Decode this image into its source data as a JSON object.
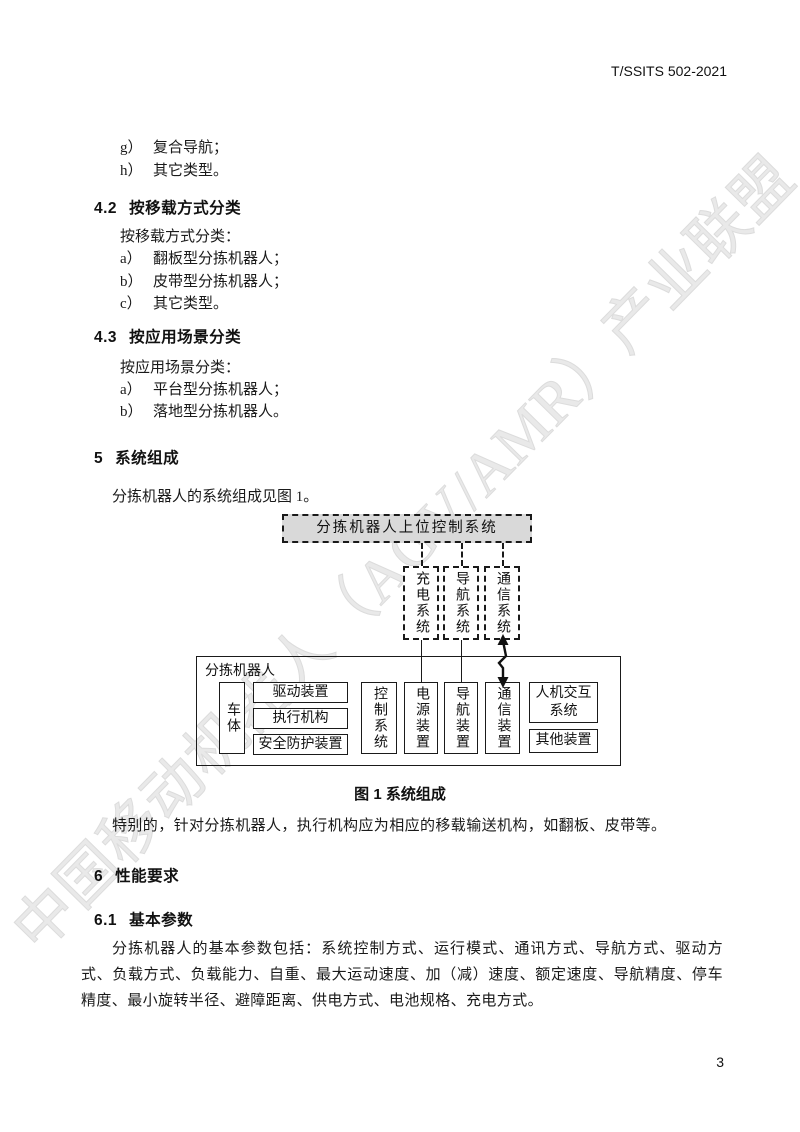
{
  "header": {
    "doc_code": "T/SSITS 502-2021"
  },
  "watermark": {
    "text": "中国移动机器人（AGV/AMR）产业联盟",
    "color": "#e9e9e9"
  },
  "colors": {
    "topbox_fill": "#d9d9d9",
    "text": "#1a1a1a"
  },
  "sections": {
    "tail_items": [
      {
        "marker": "g）",
        "text": "复合导航；"
      },
      {
        "marker": "h）",
        "text": "其它类型。"
      }
    ],
    "s42": {
      "number": "4.2",
      "title": "按移载方式分类",
      "intro": "按移载方式分类：",
      "items": [
        {
          "marker": "a）",
          "text": "翻板型分拣机器人；"
        },
        {
          "marker": "b）",
          "text": "皮带型分拣机器人；"
        },
        {
          "marker": "c）",
          "text": "其它类型。"
        }
      ]
    },
    "s43": {
      "number": "4.3",
      "title": "按应用场景分类",
      "intro": "按应用场景分类：",
      "items": [
        {
          "marker": "a）",
          "text": "平台型分拣机器人；"
        },
        {
          "marker": "b）",
          "text": "落地型分拣机器人。"
        }
      ]
    },
    "s5": {
      "number": "5",
      "title": "系统组成",
      "intro": "分拣机器人的系统组成见图 1。",
      "note": "特别的，针对分拣机器人，执行机构应为相应的移载输送机构，如翻板、皮带等。"
    },
    "s6": {
      "number": "6",
      "title": "性能要求"
    },
    "s61": {
      "number": "6.1",
      "title": "基本参数",
      "paragraph": "分拣机器人的基本参数包括：系统控制方式、运行模式、通讯方式、导航方式、驱动方式、负载方式、负载能力、自重、最大运动速度、加（减）速度、额定速度、导航精度、停车精度、最小旋转半径、避障距离、供电方式、电池规格、充电方式。"
    }
  },
  "figure": {
    "caption": "图 1  系统组成",
    "top_box": "分拣机器人上位控制系统",
    "external_systems": [
      "充电系统",
      "导航系统",
      "通信系统"
    ],
    "robot_label": "分拣机器人",
    "body_box": "车体",
    "body_subboxes": [
      "驱动装置",
      "执行机构",
      "安全防护装置"
    ],
    "module_boxes": [
      "控制系统",
      "电源装置",
      "导航装置",
      "通信装置"
    ],
    "hmi_box": "人机交互系统",
    "other_box": "其他装置"
  },
  "footer": {
    "page_number": "3"
  }
}
